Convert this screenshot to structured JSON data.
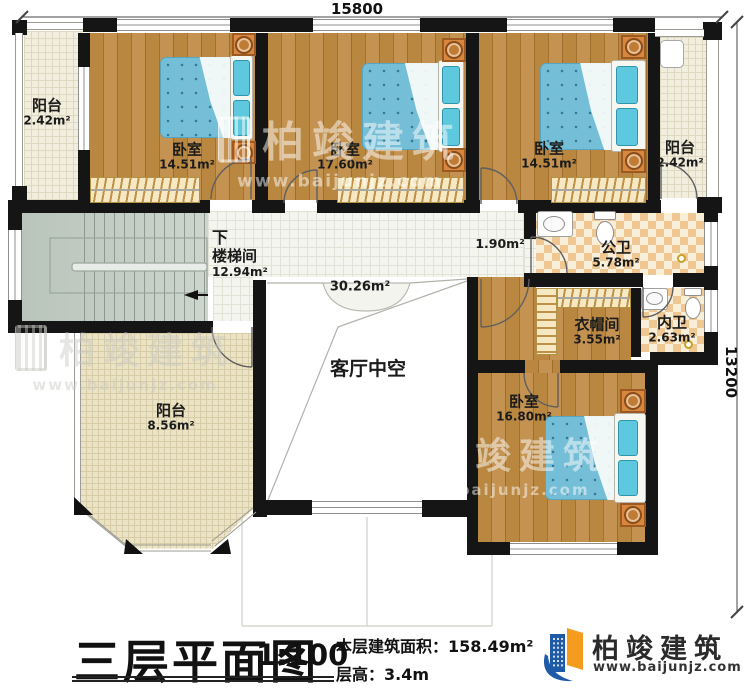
{
  "dimensions": {
    "width_mm": "15800",
    "height_mm": "13200"
  },
  "rooms": [
    {
      "id": "balcony-top-left",
      "name": "阳台",
      "area": "2.42m²"
    },
    {
      "id": "bedroom-top-left",
      "name": "卧室",
      "area": "14.51m²"
    },
    {
      "id": "bedroom-top-middle",
      "name": "卧室",
      "area": "17.60m²"
    },
    {
      "id": "bedroom-top-right",
      "name": "卧室",
      "area": "14.51m²"
    },
    {
      "id": "balcony-top-right",
      "name": "阳台",
      "area": "2.42m²"
    },
    {
      "id": "stairwell",
      "name": "楼梯间",
      "area": "12.94m²",
      "direction_label": "下"
    },
    {
      "id": "hallway",
      "name": "",
      "area": "30.26m²"
    },
    {
      "id": "vestibule",
      "name": "",
      "area": "1.90m²"
    },
    {
      "id": "public-bathroom",
      "name": "公卫",
      "area": "5.78m²"
    },
    {
      "id": "cloakroom",
      "name": "衣帽间",
      "area": "3.55m²"
    },
    {
      "id": "private-bathroom",
      "name": "内卫",
      "area": "2.63m²"
    },
    {
      "id": "living-room-void",
      "name": "客厅中空",
      "area": ""
    },
    {
      "id": "balcony-bottom-left",
      "name": "阳台",
      "area": "8.56m²"
    },
    {
      "id": "bedroom-bottom-right",
      "name": "卧室",
      "area": "16.80m²"
    }
  ],
  "title_block": {
    "title": "三层平面图",
    "scale": "1:100",
    "area_label": "本层建筑面积：",
    "area_value": "158.49m²",
    "height_label": "层高：",
    "height_value": "3.4m"
  },
  "brand": {
    "name": "柏竣建筑",
    "website": "www.baijunjz.com"
  },
  "watermark": {
    "name": "柏竣建筑",
    "website": "www.baijunjz.com"
  },
  "colors": {
    "wall": "#151515",
    "wood_floor": "#b5833f",
    "bed_blue": "#75bed7",
    "brand_blue": "#1e5aa6",
    "brand_orange": "#f59b1e"
  }
}
